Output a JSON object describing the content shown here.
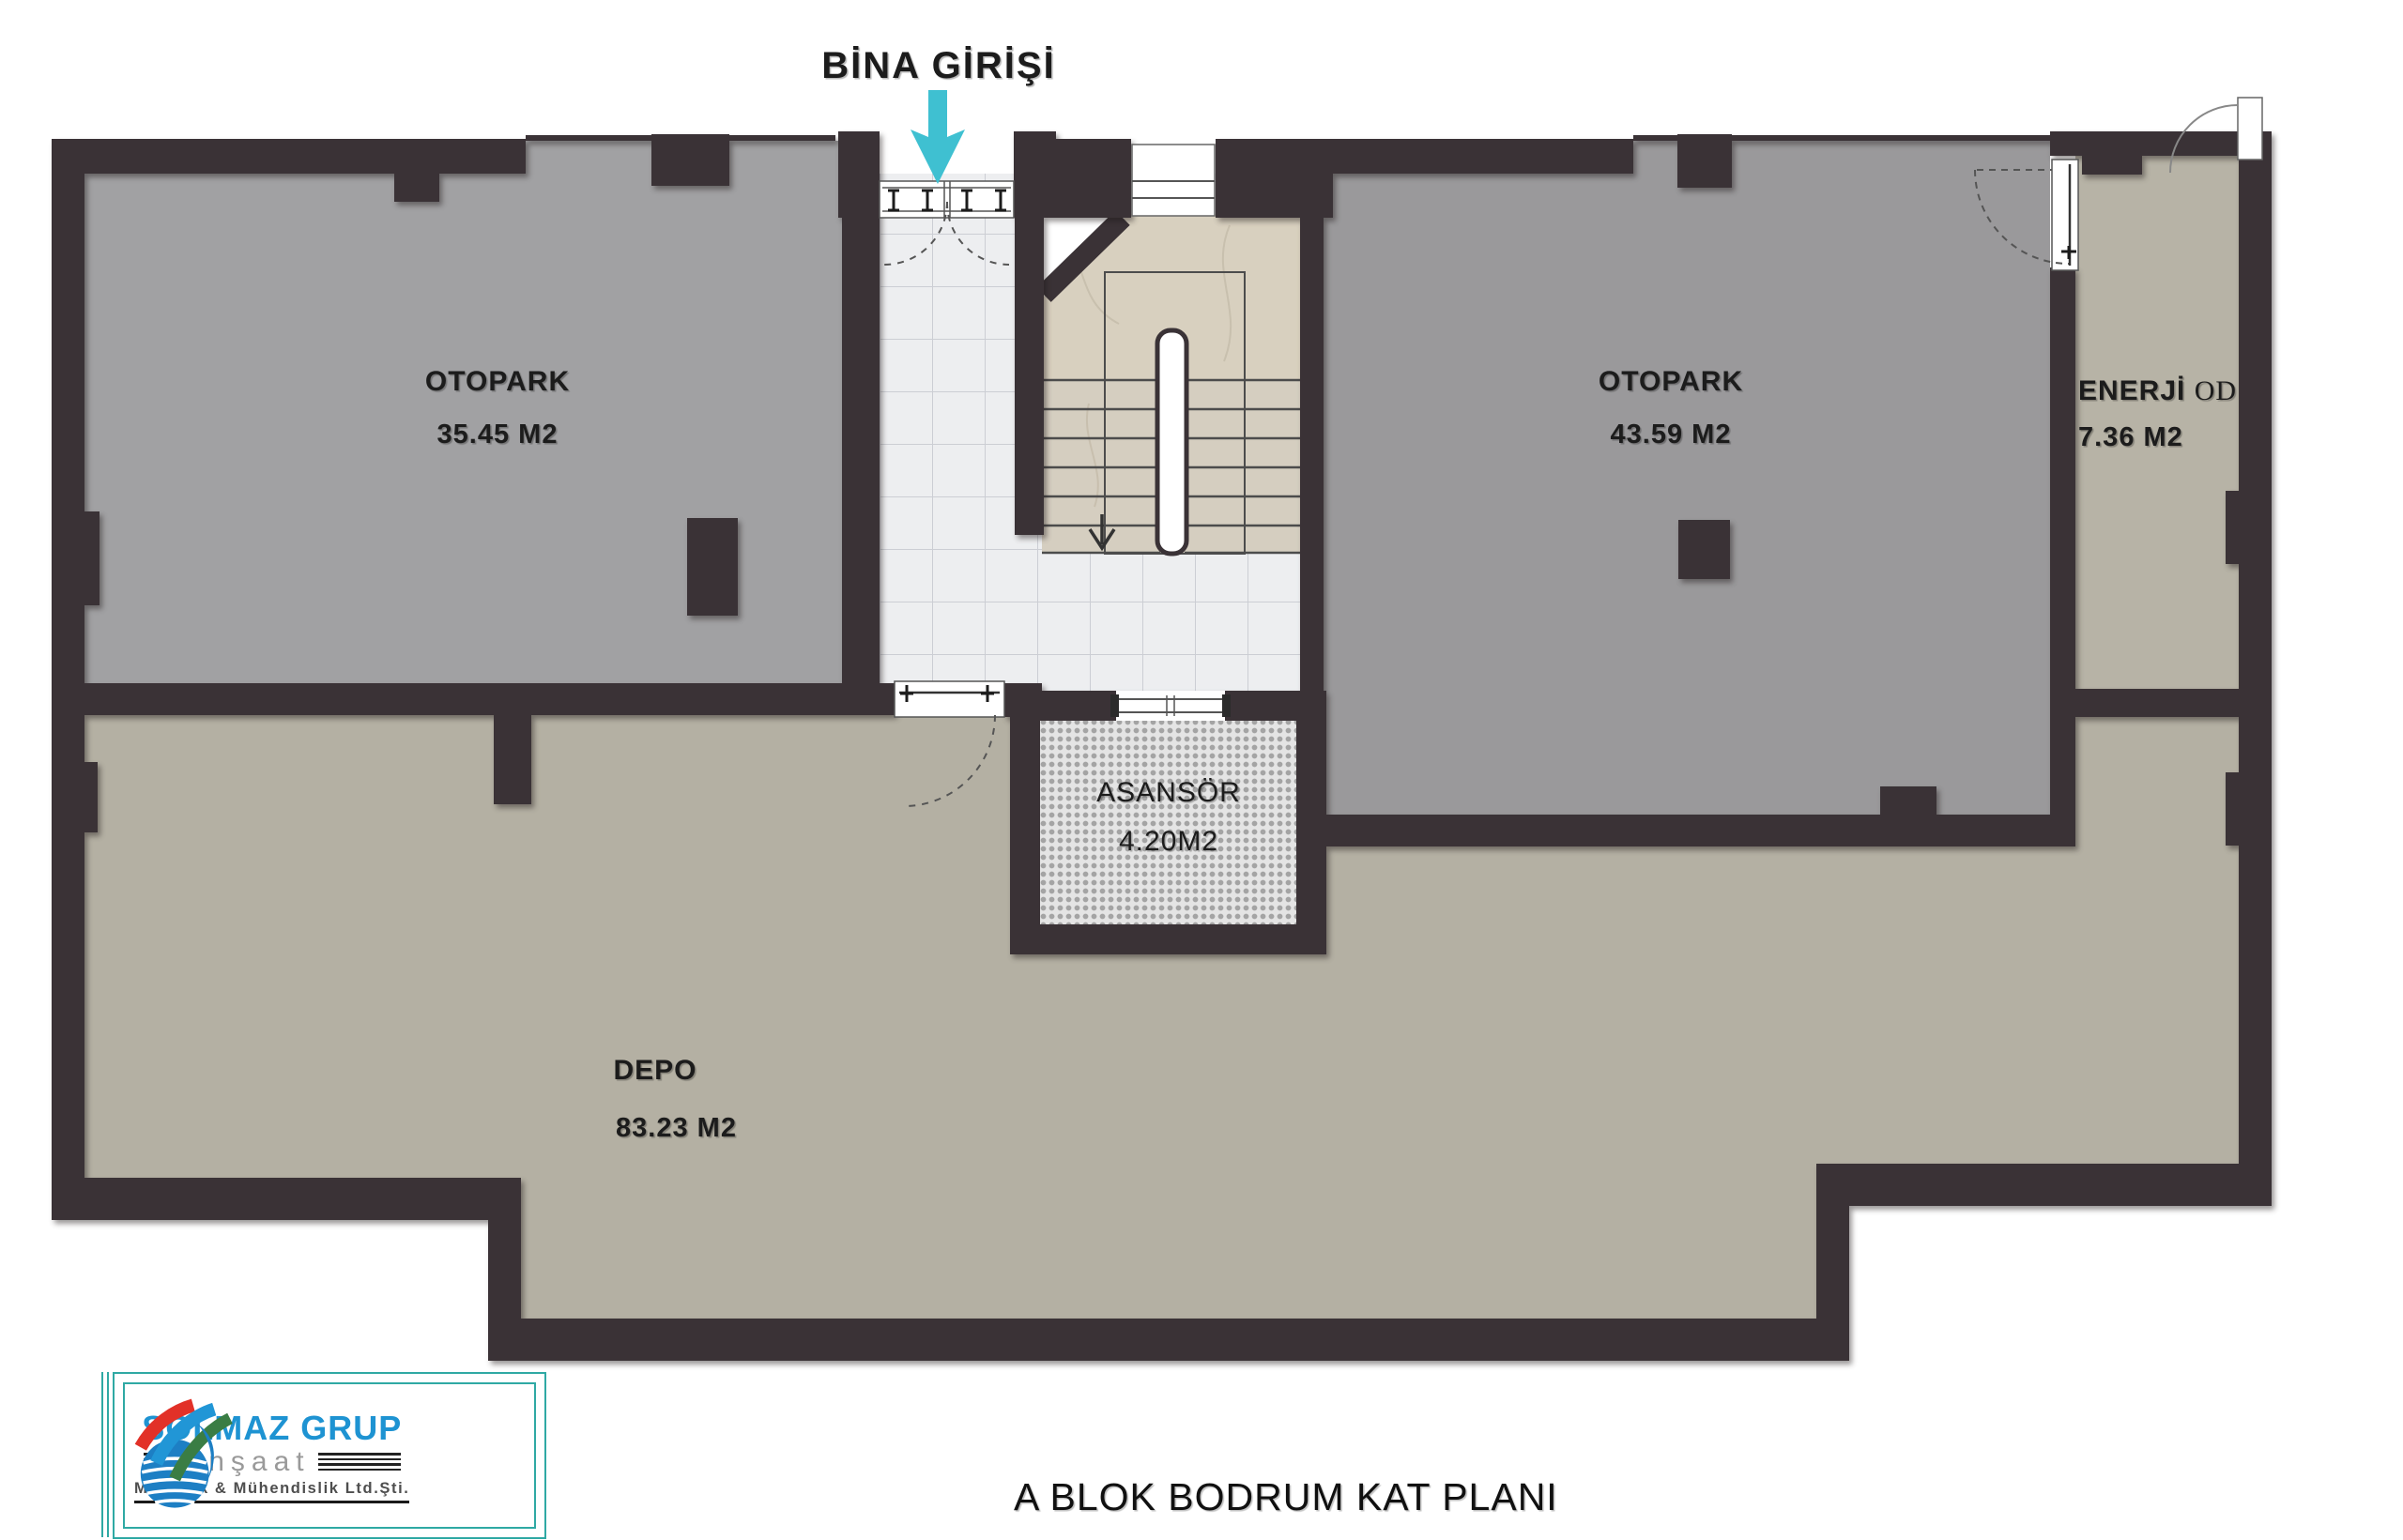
{
  "title": "A BLOK BODRUM KAT PLANI",
  "entrance_label": "BİNA GİRİŞİ",
  "rooms": {
    "otopark_left": {
      "name": "OTOPARK",
      "area": "35.45 M2"
    },
    "otopark_right": {
      "name": "OTOPARK",
      "area": "43.59 M2"
    },
    "enerji": {
      "name": "ENERJİ",
      "name_suffix": "OD",
      "area": "7.36 M2"
    },
    "asansor": {
      "name": "ASANSÖR",
      "area": "4.20M2"
    },
    "depo": {
      "name": "DEPO",
      "area": "83.23 M2"
    }
  },
  "logo": {
    "company": "SOLMAZ GRUP",
    "line2": "İnşaat",
    "line3": "Mimarlık & Mühendislik Ltd.Şti."
  },
  "colors": {
    "wall": "#3a3236",
    "accent_cyan": "#3fc0d1",
    "floor_gray": "#9e9ea0",
    "floor_beige": "#b4b0a3",
    "logo_blue": "#1e93d2",
    "logo_teal": "#2fa9a4"
  }
}
